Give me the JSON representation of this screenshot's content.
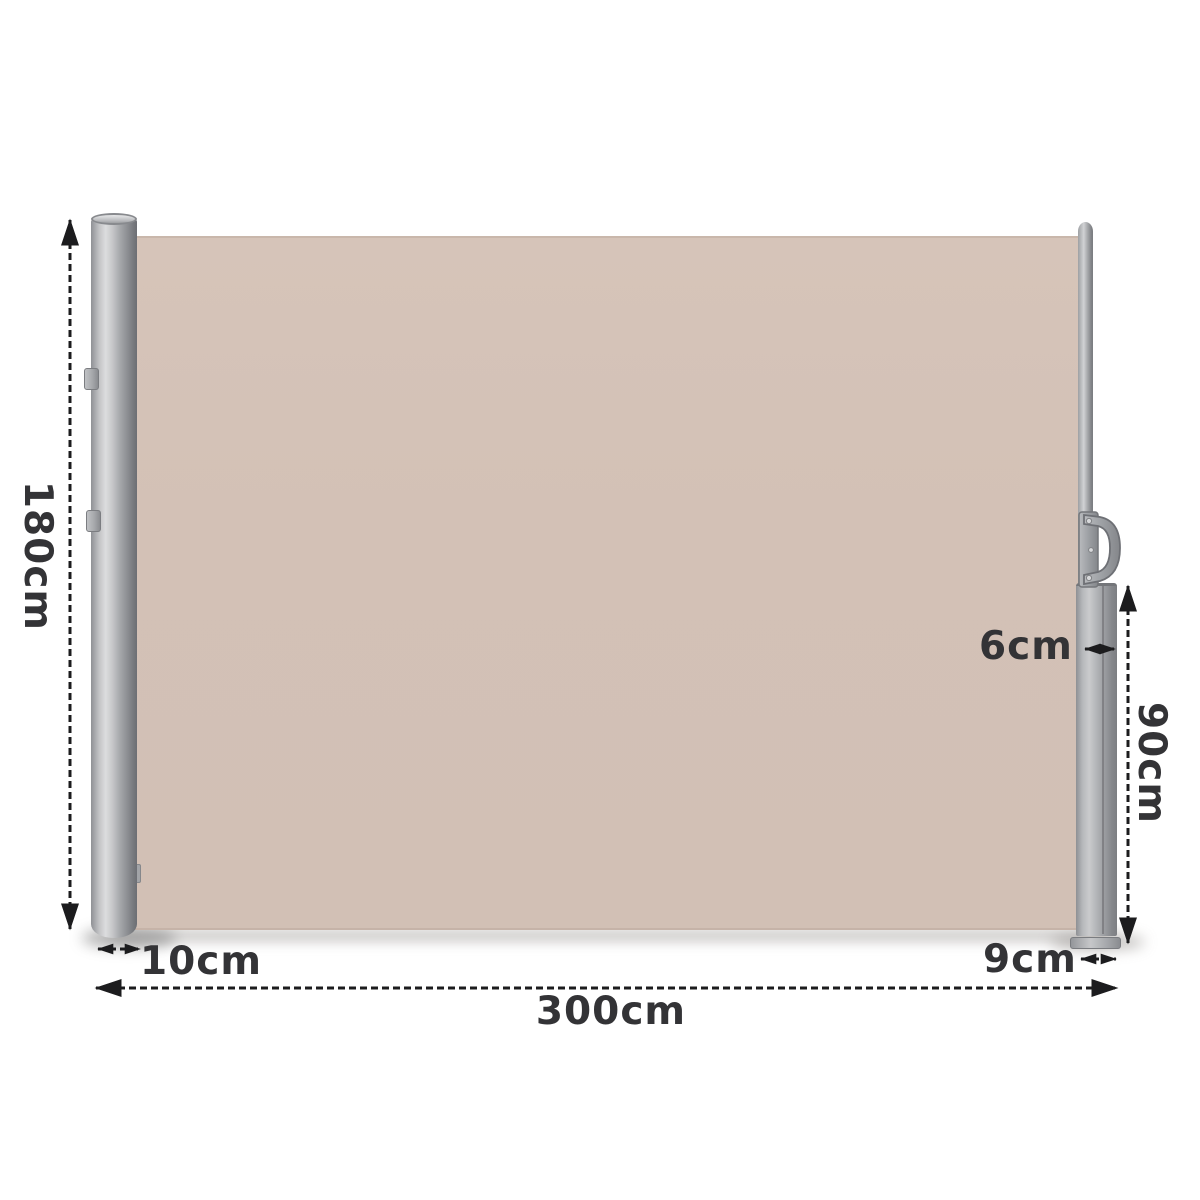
{
  "diagram": {
    "labels": {
      "total_height": "180cm",
      "pole_depth": "10cm",
      "total_length": "300cm",
      "base_depth": "9cm",
      "cassette_depth": "6cm",
      "cassette_height": "90cm"
    },
    "colors": {
      "fabric": "#d3c1b6",
      "pole_light": "#dcddde",
      "pole_dark": "#717378",
      "cassette_gray": "#9a9ca0",
      "text": "#333336",
      "arrow": "#1c1c1e",
      "background": "#ffffff"
    }
  }
}
